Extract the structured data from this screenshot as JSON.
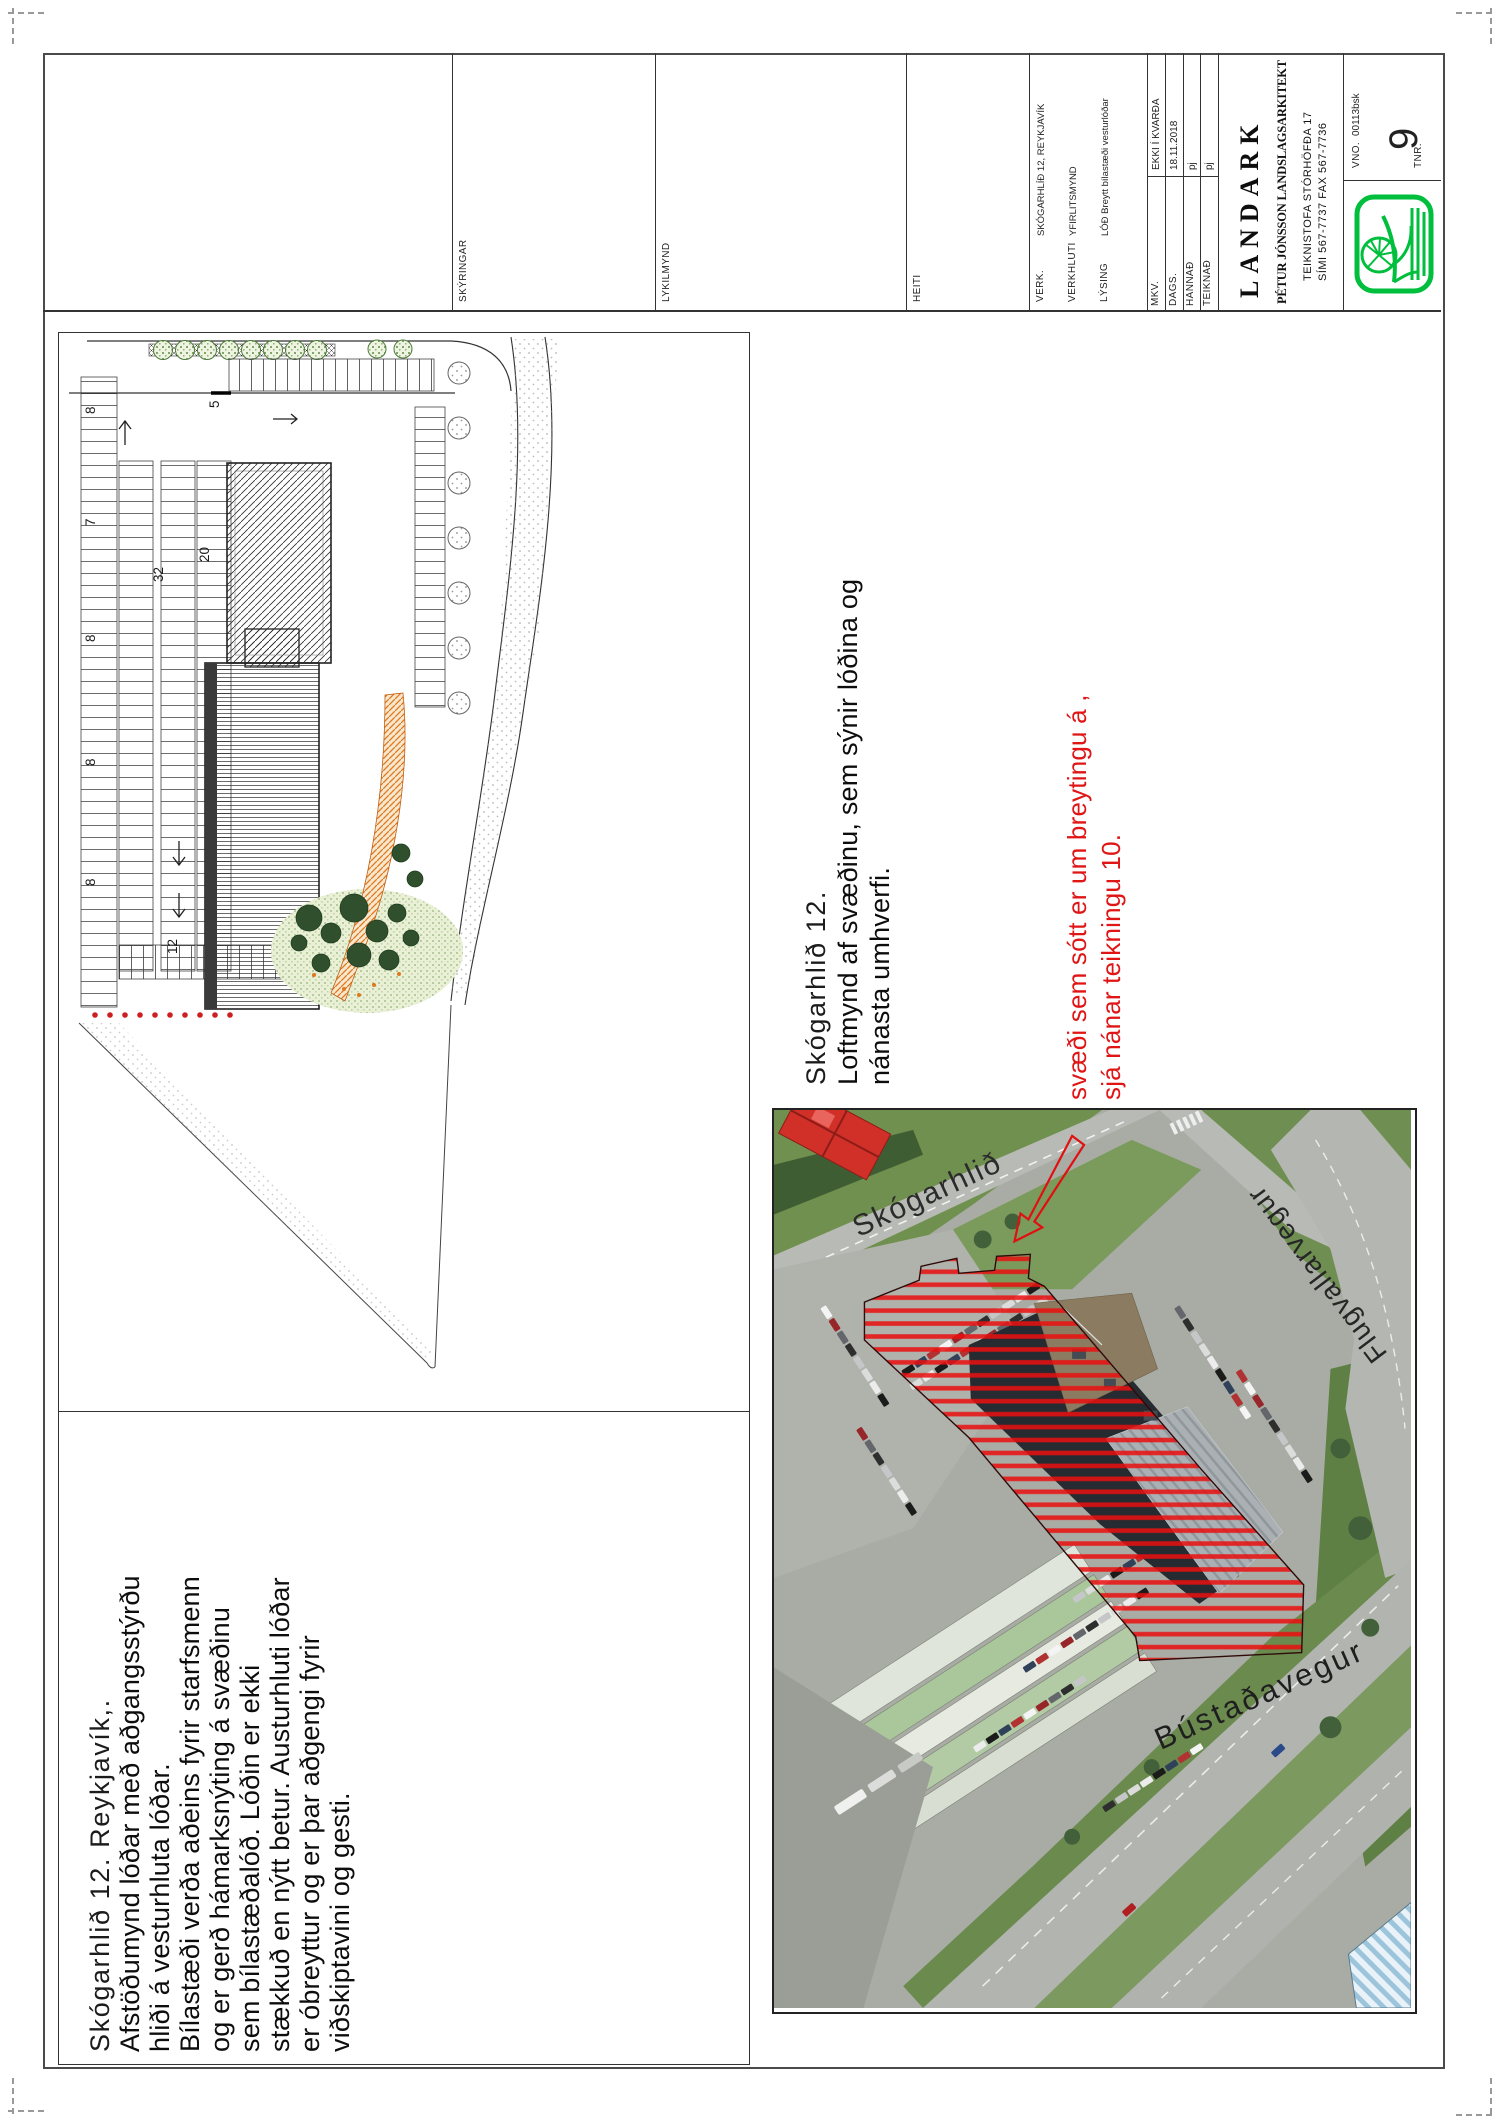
{
  "title_block": {
    "section_labels": {
      "skyringar": "SKÝRINGAR",
      "lykilmynd": "LYKILMYND",
      "heiti": "HEITI"
    },
    "fields": {
      "verk": {
        "label": "VERK.",
        "value": "SKÓGARHLÍÐ 12, REYKJAVÍK"
      },
      "verkhluti": {
        "label": "VERKHLUTI",
        "value": "YFIRLITSMYND"
      },
      "lysing": {
        "label": "LÝSING",
        "value": "LÓÐ Breytt bílastæði vesturlóðar"
      },
      "mkv": {
        "label": "MKV.",
        "value": "EKKI Í KVARÐA"
      },
      "dags": {
        "label": "DAGS.",
        "value": "18.11.2018"
      },
      "hannad": {
        "label": "HANNAÐ",
        "value": "pj"
      },
      "teiknad": {
        "label": "TEIKNAÐ",
        "value": "pj"
      },
      "vno": {
        "label": "VNO.",
        "value": "00113bsk"
      },
      "tnr": {
        "label": "TNR.",
        "value": "9"
      }
    },
    "firm": {
      "name": "LANDARK",
      "owner": "PÉTUR JÓNSSON LANDSLAGSARKITEKT",
      "address": "TEIKNISTOFA STÓRHÖFÐA 17",
      "phones": "SÍMI 567-7737 FAX 567-7736"
    }
  },
  "site_plan": {
    "stall_counts": [
      "8",
      "7",
      "8",
      "8",
      "8",
      "12"
    ],
    "mid_counts": [
      "32",
      "20",
      "5"
    ]
  },
  "notes_left": {
    "lines": [
      "Skógarhlið 12. Reykjavík,.",
      "Afstöðumynd lóðar með aðgangsstýrðu",
      "hliði á vesturhluta lóðar.",
      "Bílastæði verða aðeins fyrir starfsmenn",
      "og er gerð hámarksnýting á svæðinu",
      "sem bílastæðalóð.  Lóðin er ekki",
      "stækkuð en nýtt betur.  Austurhluti lóðar",
      "er óbreyttur og er þar aðgengi fyrir",
      "viðskiptavini og gesti."
    ]
  },
  "notes_middle": {
    "lines": [
      "Skógarhlið 12.",
      "Loftmynd af svæðinu, sem sýnir lóðina og",
      "nánasta umhverfi."
    ]
  },
  "notes_red": {
    "lines": [
      "svæði sem sótt er um breytingu á ,",
      "sjá nánar teikningu 10."
    ]
  },
  "photo": {
    "street_labels": [
      "Skógarhlið",
      "Flugvallarvegur",
      "Bústaðavegur"
    ]
  },
  "colors": {
    "accent_red": "#e01515",
    "hatch_red": "#ea0f0f",
    "logo_green": "#00bf3c"
  },
  "car_palette": [
    "#f4f4f4",
    "#1b1b1b",
    "#c4c6c8",
    "#97262a",
    "#30415a",
    "#dcdcdc",
    "#63676b",
    "#b03232",
    "#ececec",
    "#2e2e2e"
  ]
}
